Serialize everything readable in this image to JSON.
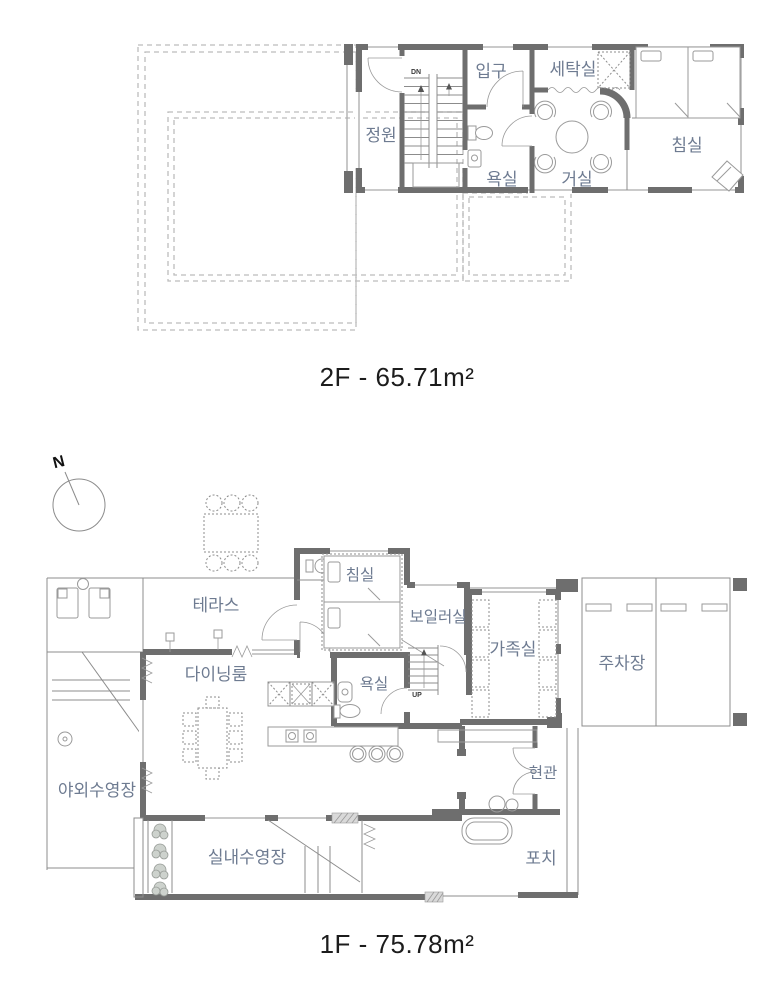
{
  "colors": {
    "wall": "#6e6e6e",
    "label": "#6e7b91",
    "caption": "#1c1c1c",
    "dash": "#bcbcbc",
    "line": "#8c8c8c"
  },
  "floor2": {
    "caption": "2F - 65.71m²",
    "stair": "DN",
    "rooms": {
      "garden": "정원",
      "entrance": "입구",
      "laundry": "세탁실",
      "bathroom": "욕실",
      "living": "거실",
      "bedroom": "침실"
    }
  },
  "floor1": {
    "caption": "1F - 75.78m²",
    "compass": "N",
    "stair": "UP",
    "rooms": {
      "terrace": "테라스",
      "bedroom": "침실",
      "boiler": "보일러실",
      "family": "가족실",
      "parking": "주차장",
      "dining": "다이닝룸",
      "bathroom": "욕실",
      "outdoor_pool": "야외수영장",
      "indoor_pool": "실내수영장",
      "entry": "현관",
      "porch": "포치"
    }
  }
}
